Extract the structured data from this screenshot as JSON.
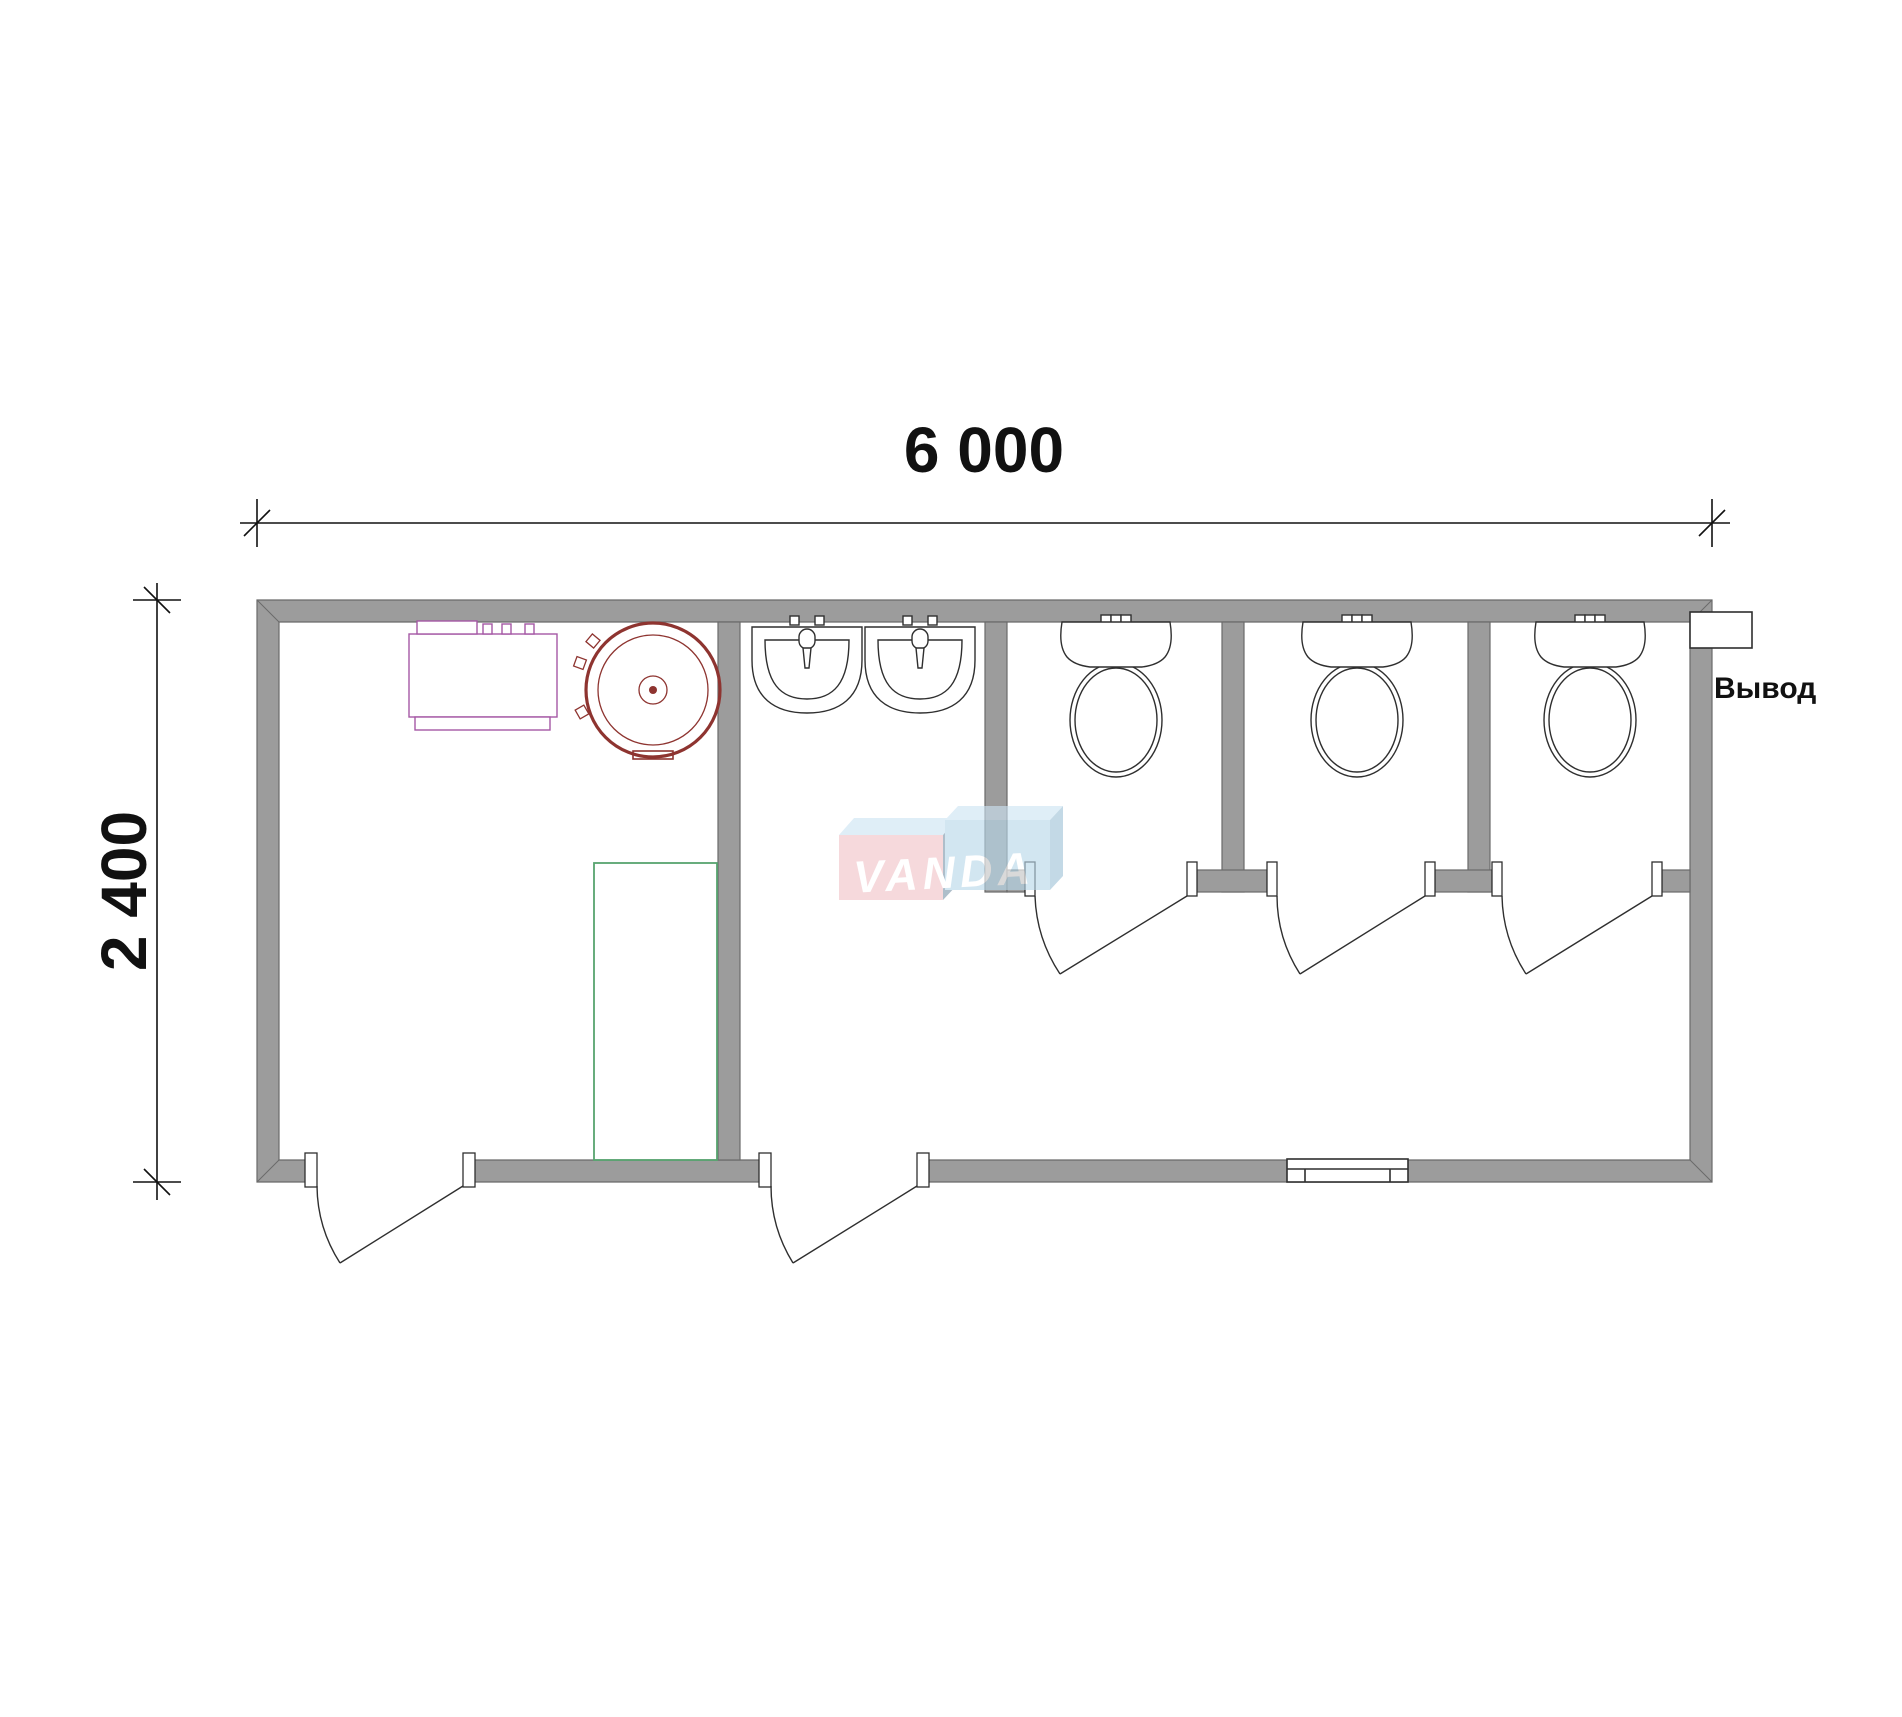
{
  "plan": {
    "width_label": "6 000",
    "height_label": "2 400",
    "outlet_label": "Вывод"
  },
  "watermark": {
    "text": "VANDA"
  },
  "colors": {
    "wall": "#9c9c9c",
    "wall_outline": "#6a6a6a",
    "line": "#2f2f2f",
    "dimension": "#111111",
    "equipment": "#a558a5",
    "boiler": "#8e3430",
    "shower": "#57a46f",
    "watermark_pink": "#f2c3c8",
    "watermark_pink_side": "#7d97ab",
    "watermark_blue": "#b8d8ea",
    "watermark_blue_side": "#9fc3d8",
    "watermark_top": "#cde4f3",
    "watermark_text": "#ffffff"
  }
}
